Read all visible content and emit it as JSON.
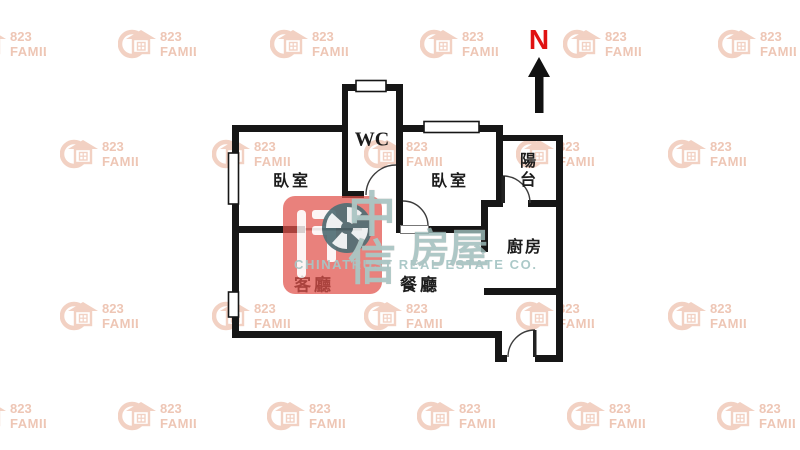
{
  "compass": {
    "label": "N",
    "color": "#e01212",
    "arrow_color": "#111111",
    "letter_x": 539,
    "letter_y": 24,
    "arrow": "539,57 550,77 543.5,77 543.5,113 535,113 535,77 528,77"
  },
  "rooms": {
    "wc": {
      "label": "WC",
      "x": 372,
      "y": 140,
      "size": 20,
      "ls": 0
    },
    "bedroom1": {
      "label": "臥室",
      "x": 292,
      "y": 179,
      "size": 16,
      "ls": 3
    },
    "bedroom2": {
      "label": "臥室",
      "x": 450,
      "y": 179,
      "size": 16,
      "ls": 3
    },
    "balcony": {
      "label": "陽台",
      "x": 528,
      "y": 171,
      "size": 16,
      "ls": 0,
      "vertical": true
    },
    "kitchen": {
      "label": "廚房",
      "x": 525,
      "y": 245,
      "size": 16,
      "ls": 2
    },
    "living": {
      "label": "客廳",
      "x": 314,
      "y": 283,
      "size": 17,
      "ls": 3
    },
    "dining": {
      "label": "餐廳",
      "x": 420,
      "y": 283,
      "size": 17,
      "ls": 3
    }
  },
  "plan": {
    "wall_color": "#161616",
    "arc_color": "#3c3c3c",
    "walls": [
      [
        232,
        125,
        7,
        213
      ],
      [
        232,
        125,
        116,
        7
      ],
      [
        342,
        84,
        6,
        114
      ],
      [
        342,
        84,
        60,
        7
      ],
      [
        396,
        84,
        7,
        149
      ],
      [
        396,
        125,
        107,
        7
      ],
      [
        496,
        125,
        7,
        82
      ],
      [
        496,
        135,
        67,
        6
      ],
      [
        556,
        135,
        7,
        227
      ],
      [
        481,
        200,
        22,
        7
      ],
      [
        528,
        200,
        28,
        7
      ],
      [
        481,
        200,
        7,
        52
      ],
      [
        484,
        288,
        72,
        7
      ],
      [
        342,
        191,
        22,
        7
      ],
      [
        232,
        226,
        73,
        7
      ],
      [
        428,
        226,
        60,
        7
      ],
      [
        232,
        331,
        270,
        7
      ],
      [
        495,
        331,
        7,
        31
      ],
      [
        495,
        355,
        12,
        7
      ],
      [
        535,
        355,
        28,
        7
      ]
    ],
    "thin_walls": [
      [
        305,
        228,
        57,
        2.5
      ]
    ],
    "thin_color": "#8f8f8f",
    "windows": [
      [
        228.5,
        153,
        10,
        51
      ],
      [
        228.5,
        292,
        10,
        25
      ],
      [
        356,
        80.5,
        30,
        11
      ],
      [
        424,
        121.5,
        55,
        11
      ]
    ],
    "door_discs": [
      "M396,195 L366,195 A30,30 0 0 1 396,165 Z",
      "M403,226 L403,201 A25,25 0 0 1 428,226 Z",
      "M503,203 L503,176 A27,27 0 0 1 530,203 Z",
      "M535,357 L508,357 A27,27 0 0 1 535,330 Z"
    ],
    "door_arcs": [
      "M366,195 A30,30 0 0 1 396,165",
      "M403,201 A25,25 0 0 1 428,226",
      "M503,176 A27,27 0 0 1 530,203",
      "M508,357 A27,27 0 0 1 535,330"
    ],
    "door_leaves": [
      [
        501.5,
        176,
        3.5,
        27
      ],
      [
        533,
        330,
        3.5,
        27
      ]
    ],
    "threshold": [
      400.5,
      225.5,
      28,
      8
    ]
  },
  "watermark823": {
    "line1": "823",
    "line2": "FAMILY",
    "shape_color": "#f2d1c3",
    "text_color": "#eec6b5",
    "positions": [
      [
        -32,
        28
      ],
      [
        118,
        28
      ],
      [
        270,
        28
      ],
      [
        420,
        28
      ],
      [
        563,
        28
      ],
      [
        718,
        28
      ],
      [
        60,
        138
      ],
      [
        212,
        138
      ],
      [
        364,
        138
      ],
      [
        516,
        138
      ],
      [
        668,
        138
      ],
      [
        60,
        300
      ],
      [
        212,
        300
      ],
      [
        364,
        300
      ],
      [
        516,
        300
      ],
      [
        668,
        300
      ],
      [
        -32,
        400
      ],
      [
        118,
        400
      ],
      [
        267,
        400
      ],
      [
        417,
        400
      ],
      [
        567,
        400
      ],
      [
        717,
        400
      ]
    ]
  },
  "chinatrust": {
    "square": {
      "x": 283,
      "y": 196,
      "w": 99,
      "h": 98,
      "color": "#e0514a"
    },
    "pinwheel_color": "#34565e",
    "chars": [
      {
        "t": "中",
        "x": 372,
        "y": 210,
        "size": 48
      },
      {
        "t": "信",
        "x": 372,
        "y": 258,
        "size": 48
      },
      {
        "t": "房",
        "x": 430,
        "y": 245,
        "size": 40
      },
      {
        "t": "屋",
        "x": 469,
        "y": 245,
        "size": 40
      }
    ],
    "caption": {
      "text": "CHINATRUST REAL ESTATE CO.",
      "x": 294,
      "y": 257
    }
  }
}
